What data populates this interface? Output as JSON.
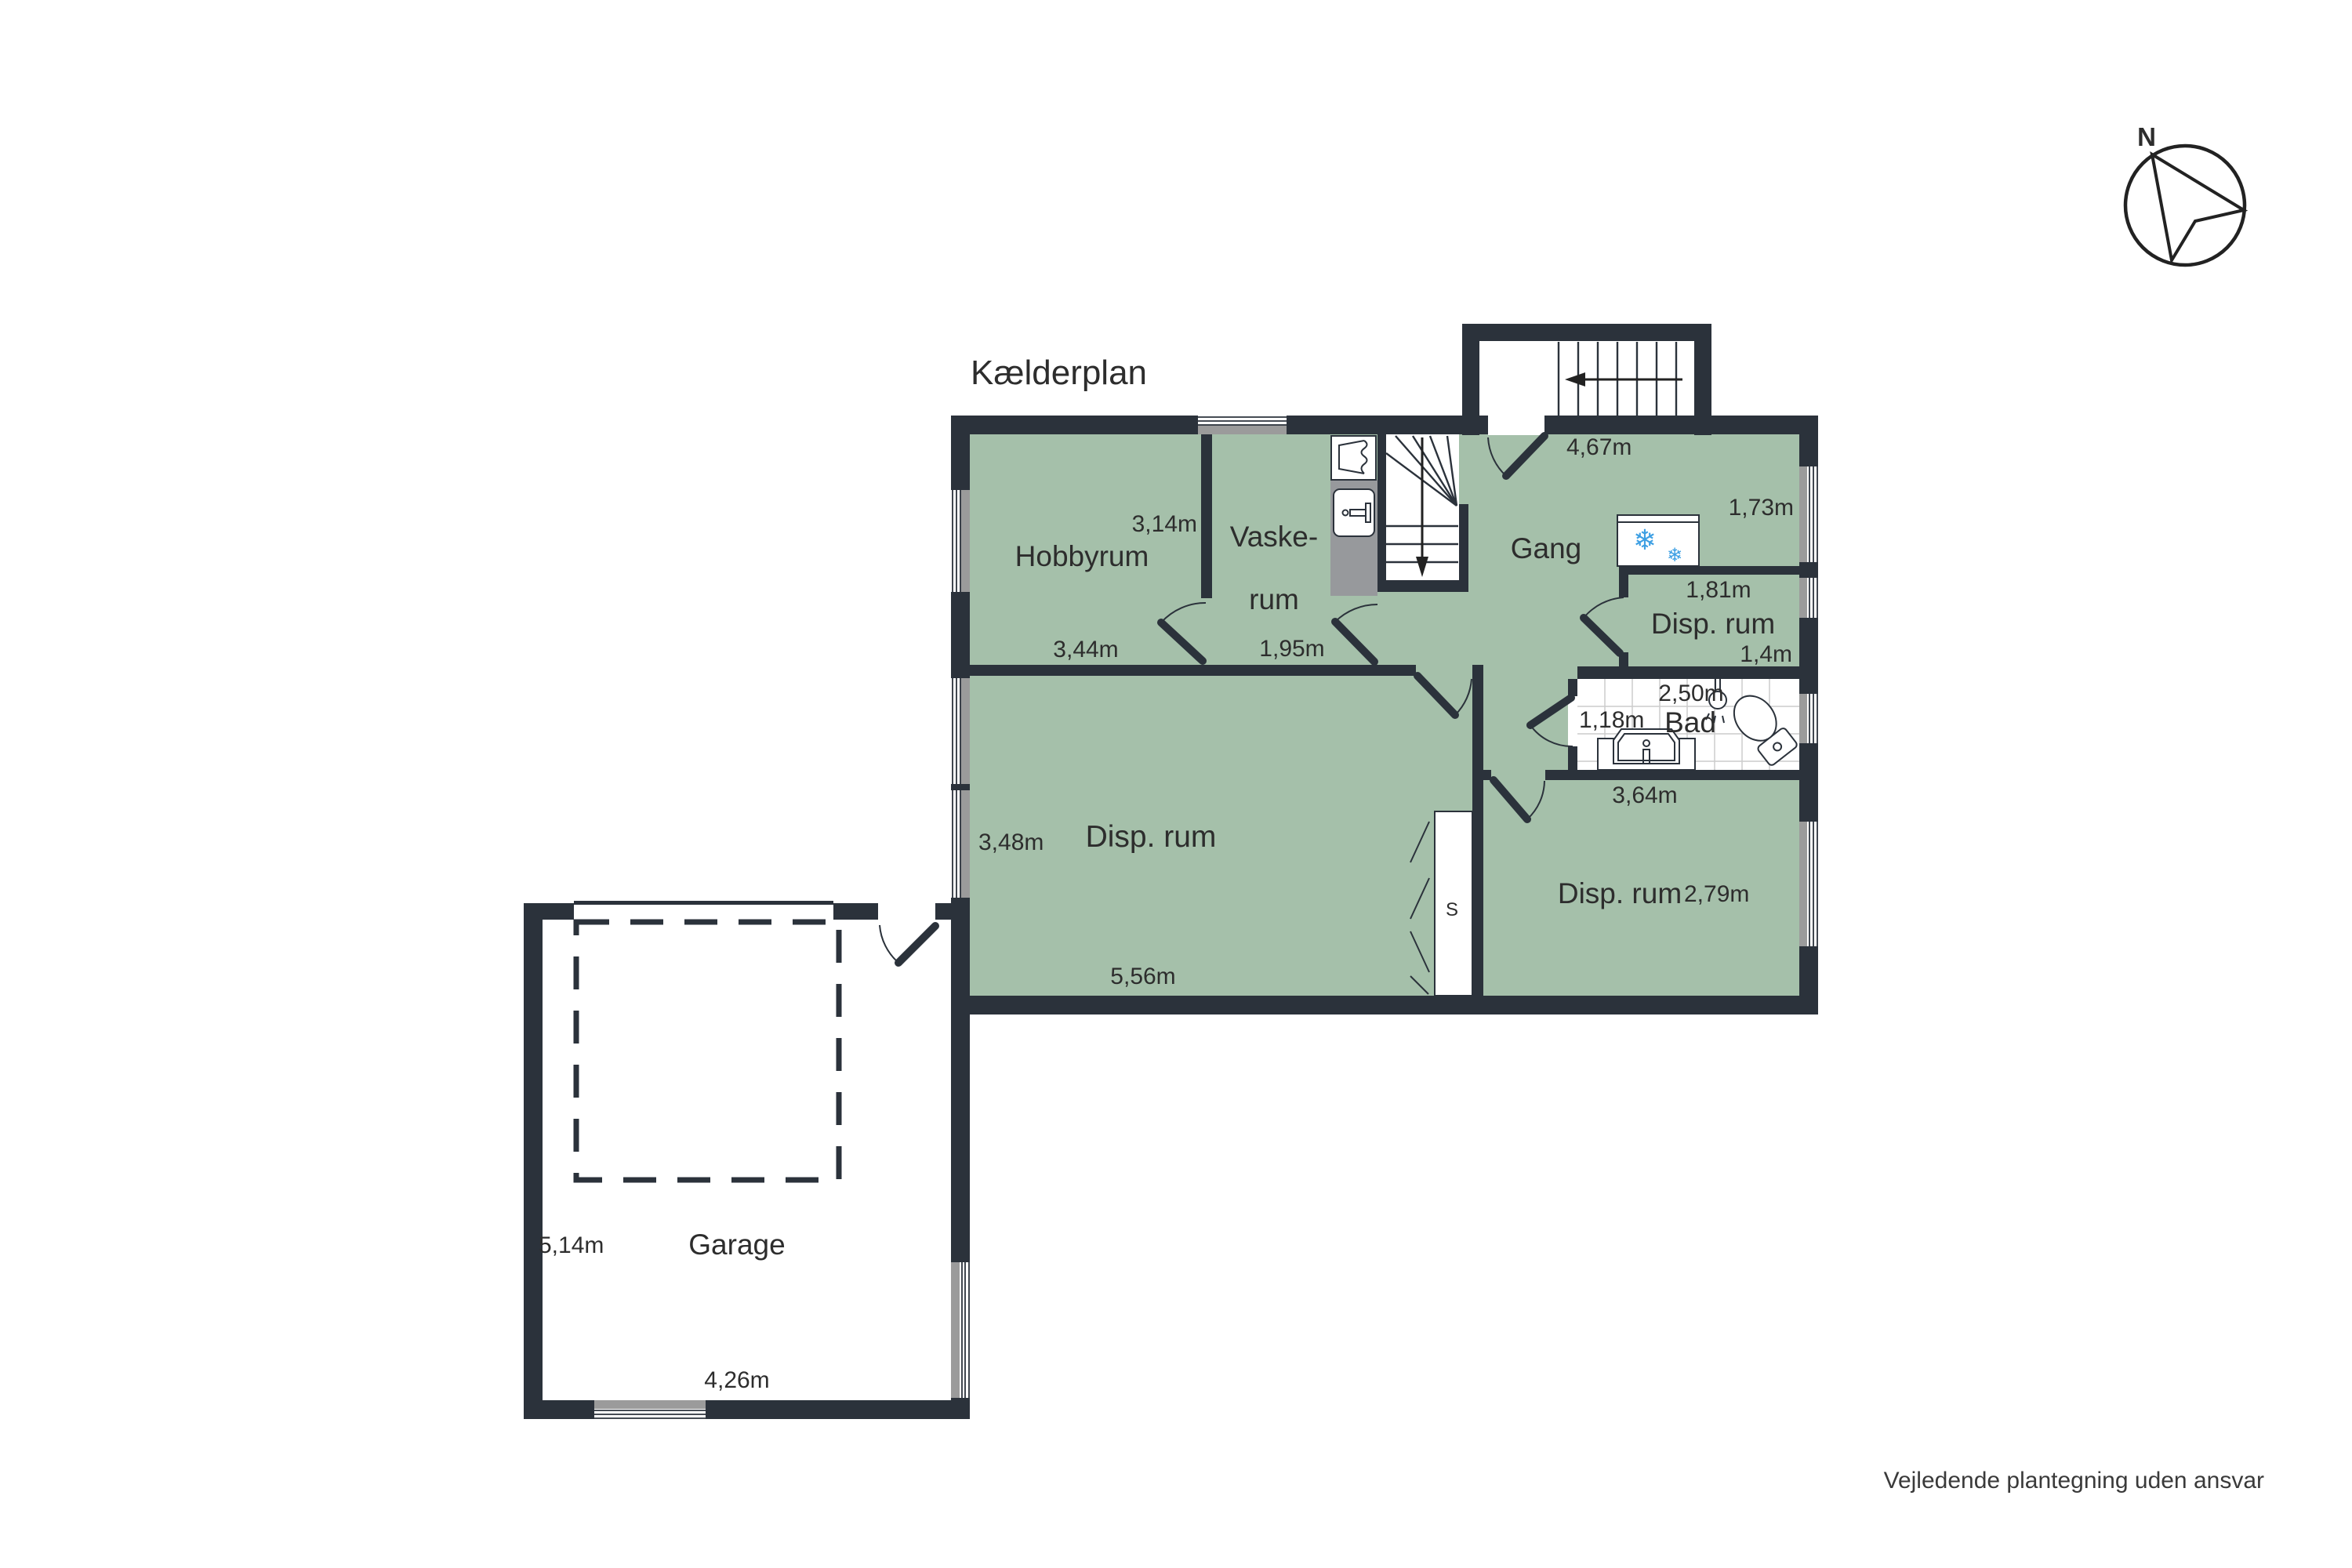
{
  "title": "Kælderplan",
  "compass": {
    "north_label": "N"
  },
  "footer": {
    "disclaimer": "Vejledende plantegning uden ansvar"
  },
  "rooms": {
    "hobbyrum": {
      "name": "Hobbyrum",
      "dim_height": "3,14m",
      "dim_width": "3,44m"
    },
    "vaskerum": {
      "name_line1": "Vaske-",
      "name_line2": "rum",
      "dim_width": "1,95m"
    },
    "gang": {
      "name": "Gang",
      "dim_width": "4,67m",
      "dim_depth": "1,73m"
    },
    "disp_small": {
      "name": "Disp. rum",
      "dim_width": "1,81m",
      "dim_depth": "1,4m"
    },
    "bad": {
      "name": "Bad",
      "dim_width": "2,50m",
      "dim_left": "1,18m"
    },
    "disp_big": {
      "name": "Disp. rum",
      "dim_height": "3,48m",
      "dim_width": "5,56m"
    },
    "disp_bottom": {
      "name": "Disp. rum",
      "dim_width": "3,64m",
      "dim_depth": "2,79m"
    },
    "closet": {
      "name": "S"
    },
    "garage": {
      "name": "Garage",
      "dim_height": "5,14m",
      "dim_width": "4,26m"
    }
  },
  "icons": {
    "freezer_snowflake_large": "❄",
    "freezer_snowflake_small": "❄"
  },
  "colors": {
    "wall": "#2b323b",
    "room_fill": "#a5c0aa",
    "counter_gray": "#97999c",
    "window_gray": "#9b9b9b",
    "snowflake_blue": "#3d9fe3",
    "tile_line": "#cccccc",
    "text": "#2d2d2d"
  }
}
